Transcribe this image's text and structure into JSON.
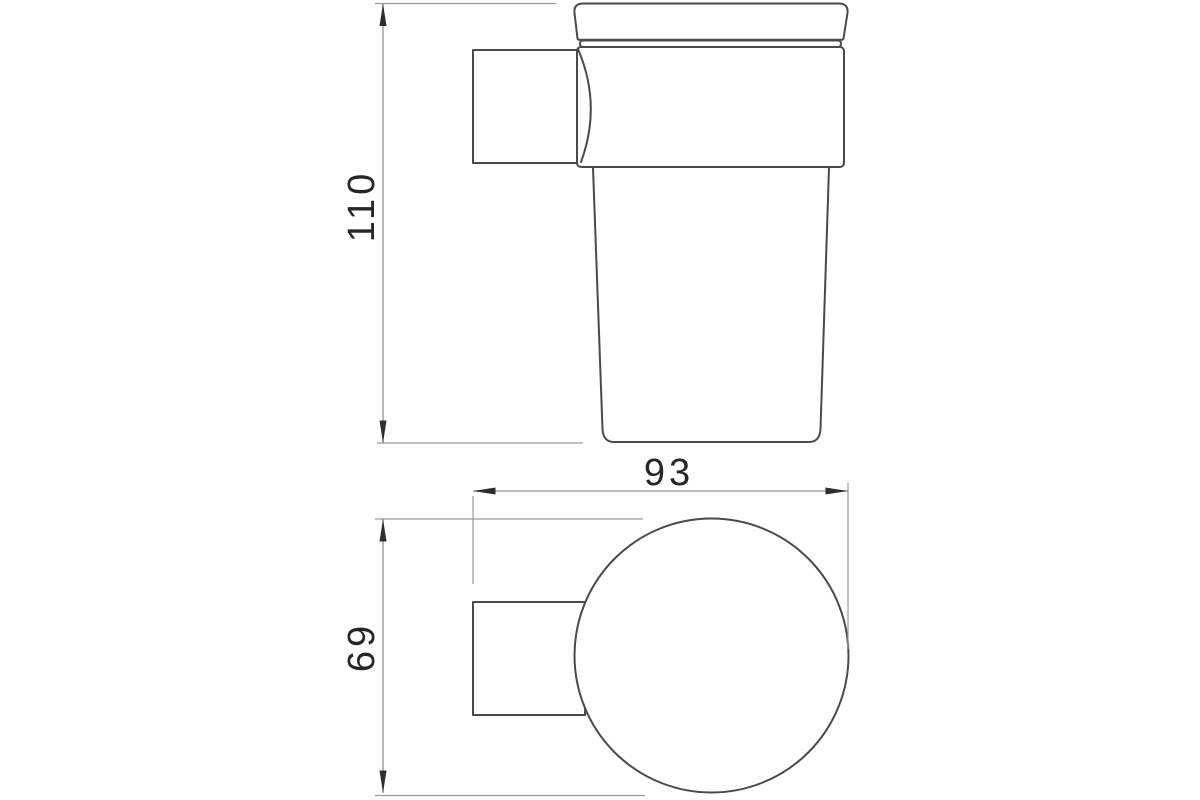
{
  "drawing": {
    "dimensions": {
      "height": "110",
      "depth": "93",
      "diameter": "69"
    },
    "colors": {
      "background": "#ffffff",
      "object_line": "#4a4a4a",
      "dimension_line": "#909090",
      "extension_line": "#9a9a9a",
      "arrow": "#2e2e2e",
      "text": "#262626"
    }
  }
}
